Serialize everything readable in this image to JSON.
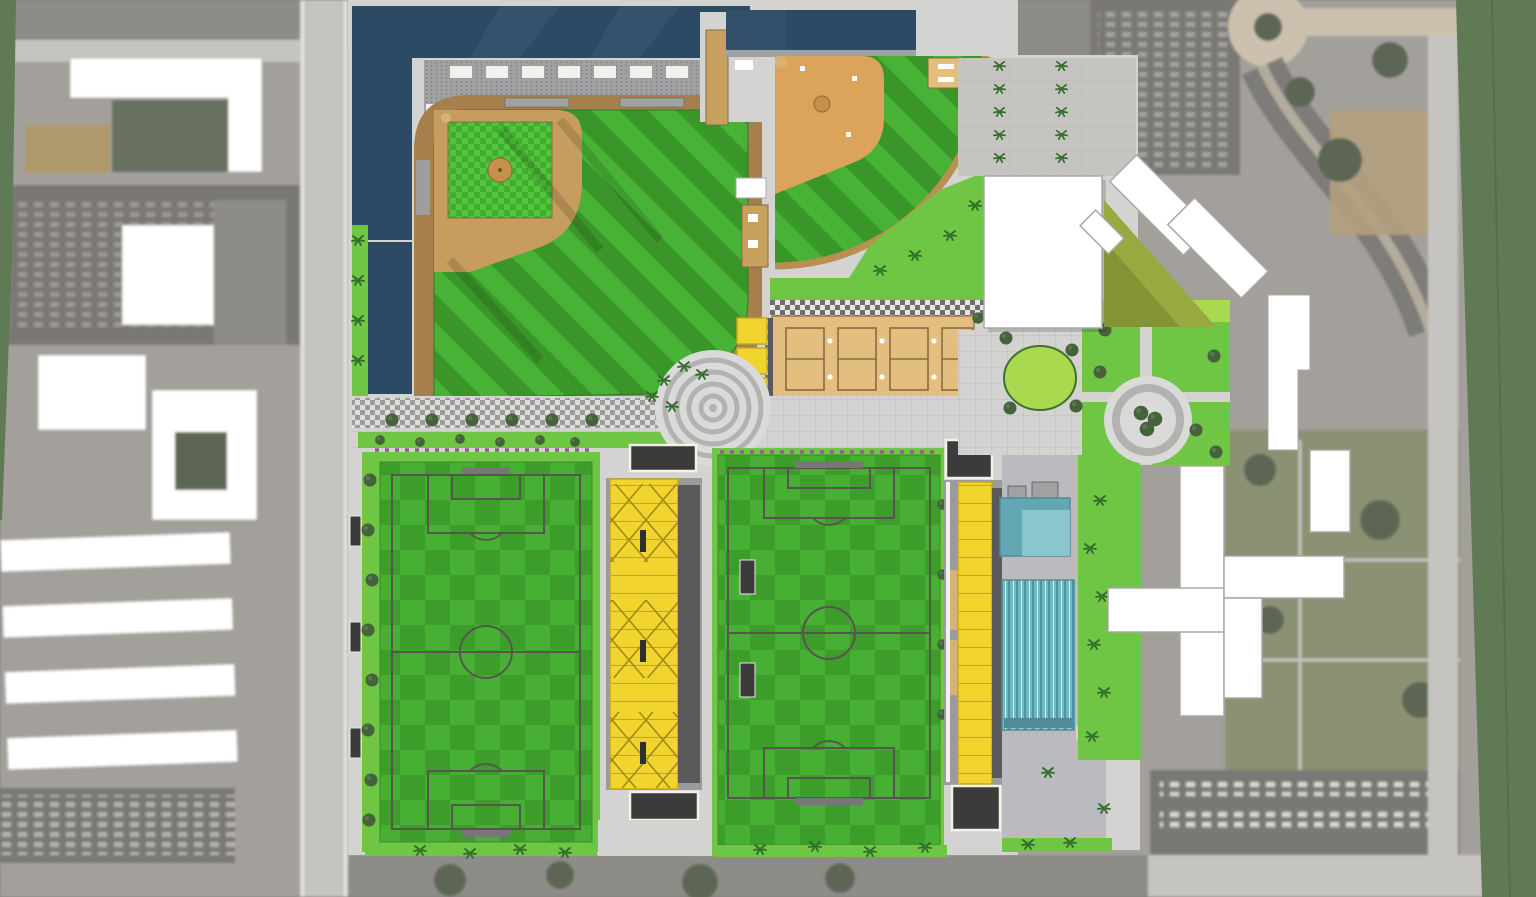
{
  "meta": {
    "width": 1536,
    "height": 897,
    "kind": "sports-complex-master-plan-aerial-rendering"
  },
  "colors": {
    "aerialBase": "#a3a09b",
    "aerialRoad": "#c6c4c0",
    "aerialBlock": "#8e8c87",
    "aerialParking": "#7a7874",
    "aerialTrees": "#5d6654",
    "aerialOlive": "#8b9173",
    "aerialDirt": "#b3a07e",
    "roundTan": "#cbc1ae",
    "carShade": "#e9e9e7",
    "white": "#ffffff",
    "whiteStroke": "#a8a8a6",
    "shadow": "#000000",
    "sage": "#5f7a55",
    "sageSeam": "#4e6746",
    "paver": "#d3d3d1",
    "paverLine": "#bcbcba",
    "plazaGround": "#dadad8",
    "plazaRing": "#b2b2b0",
    "navy": "#2c4a63",
    "navyLight": "#46607a",
    "suite": "#f2f1ec",
    "seat": "#a0a1a3",
    "seatDot": "#55555a",
    "brown": "#a5804c",
    "track": "#b98f52",
    "dirt": "#c69d5e",
    "dirtOrange": "#dca45a",
    "mound": "#c3914a",
    "homeDirt": "#d6b277",
    "stripeA": "#47b236",
    "stripeB": "#3a9629",
    "checkA": "#47b034",
    "checkB": "#3d9d2b",
    "inA": "#52c43e",
    "inB": "#41ad2d",
    "lawn": "#6fc544",
    "lawnLight": "#8bd24f",
    "eventLawn": "#a9d94e",
    "hedge": "#3f7030",
    "tree": "#45633b",
    "palm": "#2f6b2a",
    "flower": "#a0539f",
    "pad": "#e3bf7f",
    "courtLine": "#8a6a40",
    "yellow": "#f2d42f",
    "yellowEdge": "#c4a81e",
    "brace": "#a08c17",
    "pavilion": "#3b3b3b",
    "frame": "#f5f2e6",
    "grayBldg": "#9b9b9d",
    "graySide": "#5a5a5c",
    "deck": "#babbbe",
    "poolDark": "#63a7b5",
    "poolLight": "#8fc9d0",
    "poolEdge": "#4f8b98",
    "lapBase": "#74b7c4",
    "laneDark": "#4e93a4",
    "laneLight": "#d8f0f2",
    "fieldLine": "#56564c",
    "goal": "#777777",
    "walkDark": "#6f6f6d",
    "walkLight": "#e6e6e4",
    "tanTower": "#c9a15f",
    "tanRoof": "#b09a6c",
    "bench": "#2f2f2f",
    "benchFrame": "#e8e8e6"
  }
}
